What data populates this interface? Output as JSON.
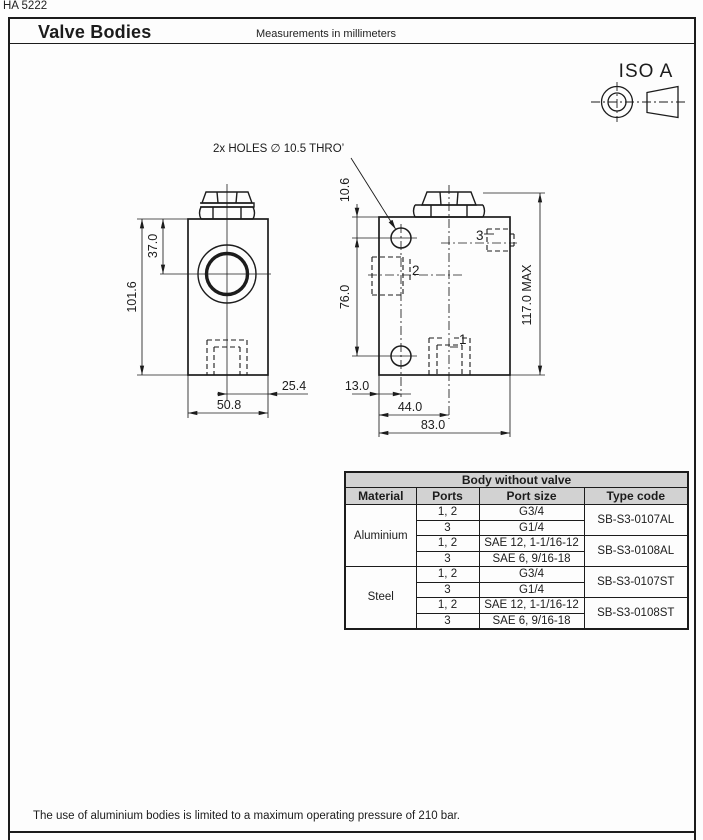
{
  "doc_code": "HA 5222",
  "header": {
    "title": "Valve Bodies",
    "subtitle": "Measurements in millimeters"
  },
  "iso": {
    "label": "ISO A"
  },
  "drawing": {
    "note": "2x HOLES ∅ 10.5 THRO’",
    "dims": {
      "w37": "37.0",
      "h101": "101.6",
      "off25": "25.4",
      "w50": "50.8",
      "t10": "10.6",
      "s76": "76.0",
      "max117": "117.0 MAX",
      "e13": "13.0",
      "c44": "44.0",
      "w83": "83.0"
    },
    "ports": {
      "p1": "1",
      "p2": "2",
      "p3": "3"
    }
  },
  "table": {
    "title": "Body without valve",
    "columns": [
      "Material",
      "Ports",
      "Port size",
      "Type code"
    ],
    "groups": [
      {
        "material": "Aluminium",
        "variants": [
          {
            "code": "SB-S3-0107AL",
            "rows": [
              {
                "ports": "1, 2",
                "size": "G3/4"
              },
              {
                "ports": "3",
                "size": "G1/4"
              }
            ]
          },
          {
            "code": "SB-S3-0108AL",
            "rows": [
              {
                "ports": "1, 2",
                "size": "SAE 12, 1-1/16-12"
              },
              {
                "ports": "3",
                "size": "SAE 6, 9/16-18"
              }
            ]
          }
        ]
      },
      {
        "material": "Steel",
        "variants": [
          {
            "code": "SB-S3-0107ST",
            "rows": [
              {
                "ports": "1, 2",
                "size": "G3/4"
              },
              {
                "ports": "3",
                "size": "G1/4"
              }
            ]
          },
          {
            "code": "SB-S3-0108ST",
            "rows": [
              {
                "ports": "1, 2",
                "size": "SAE 12, 1-1/16-12"
              },
              {
                "ports": "3",
                "size": "SAE 6, 9/16-18"
              }
            ]
          }
        ]
      }
    ]
  },
  "footnote": "The use of aluminium bodies is limited to a maximum operating pressure of 210 bar."
}
